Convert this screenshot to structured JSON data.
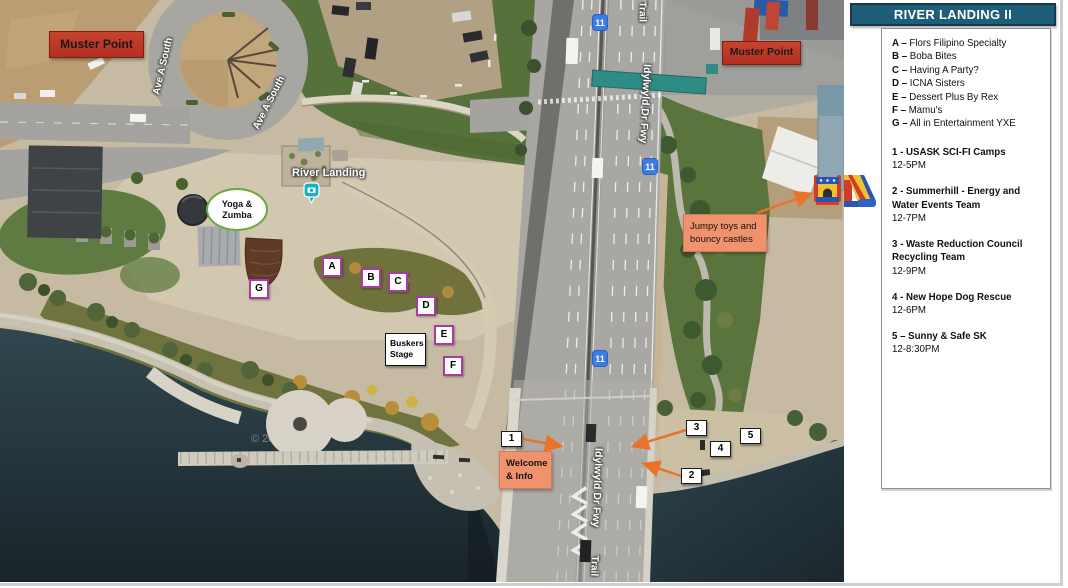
{
  "legend": {
    "title": "RIVER LANDING II",
    "vendors": [
      {
        "prefix": "A –",
        "name": "Flors Filipino Specialty"
      },
      {
        "prefix": "B –",
        "name": "Boba Bites"
      },
      {
        "prefix": "C –",
        "name": "Having A Party?"
      },
      {
        "prefix": "D –",
        "name": "ICNA Sisters"
      },
      {
        "prefix": "E –",
        "name": "Dessert Plus By Rex"
      },
      {
        "prefix": "F –",
        "name": "Mamu's"
      },
      {
        "prefix": "G –",
        "name": "All in Entertainment YXE"
      }
    ],
    "activities": [
      {
        "name": "1 - USASK SCI-FI Camps",
        "time": "12-5PM"
      },
      {
        "name": "2 - Summerhill - Energy and Water Events Team",
        "time": "12-7PM"
      },
      {
        "name": "3 - Waste Reduction Council Recycling Team",
        "time": "12-9PM"
      },
      {
        "name": "4 - New Hope Dog Rescue",
        "time": "12-6PM"
      },
      {
        "name": "5 – Sunny & Safe SK",
        "time": "12-8:30PM"
      }
    ]
  },
  "map": {
    "labels": {
      "muster_point": "Muster Point",
      "yoga_line1": "Yoga &",
      "yoga_line2": "Zumba",
      "river_landing": "River Landing",
      "buskers_line1": "Buskers",
      "buskers_line2": "Stage",
      "jumpy_line1": "Jumpy toys and",
      "jumpy_line2": "bouncy castles",
      "welcome_line1": "Welcome",
      "welcome_line2": "& Info",
      "copyright": "© 2022 Google"
    },
    "road_labels": {
      "trail": "Trail",
      "idylwyld": "Idylwyld Dr Fwy",
      "ave_a_south": "Ave A South",
      "shield": "11"
    },
    "markers": {
      "letters": [
        "A",
        "B",
        "C",
        "D",
        "E",
        "F",
        "G"
      ],
      "numbers": [
        "1",
        "2",
        "3",
        "4",
        "5"
      ]
    }
  },
  "colors": {
    "accent_orange": "#E8732A",
    "marker_purple": "#AC3AA4",
    "muster_red": "#BC3524",
    "salmon_label": "#F0926E",
    "header_teal": "#1F5E78",
    "shield_blue": "#3D7BE5",
    "water": "#22333B"
  }
}
